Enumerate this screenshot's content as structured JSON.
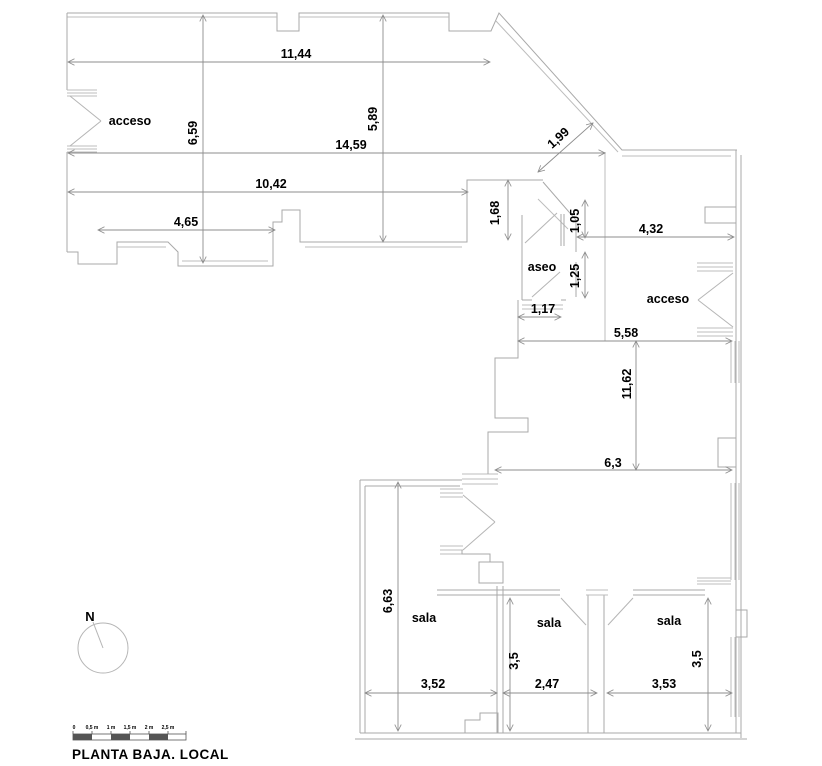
{
  "title": "PLANTA BAJA. LOCAL",
  "colors": {
    "background": "#ffffff",
    "wall_line": "#a9a9a9",
    "dimension_line": "#8c8c8c",
    "text": "#000000"
  },
  "north": {
    "label": "N"
  },
  "rooms": [
    {
      "name": "acceso-left",
      "label": "acceso"
    },
    {
      "name": "aseo",
      "label": "aseo"
    },
    {
      "name": "acceso-right",
      "label": "acceso"
    },
    {
      "name": "sala-1",
      "label": "sala"
    },
    {
      "name": "sala-2",
      "label": "sala"
    },
    {
      "name": "sala-3",
      "label": "sala"
    }
  ],
  "dimensions": [
    {
      "label": "11,44",
      "orientation": "horizontal"
    },
    {
      "label": "6,59",
      "orientation": "vertical"
    },
    {
      "label": "14,59",
      "orientation": "horizontal"
    },
    {
      "label": "5,89",
      "orientation": "vertical"
    },
    {
      "label": "1,99",
      "orientation": "diagonal"
    },
    {
      "label": "10,42",
      "orientation": "horizontal"
    },
    {
      "label": "4,65",
      "orientation": "horizontal"
    },
    {
      "label": "1,68",
      "orientation": "vertical"
    },
    {
      "label": "1,05",
      "orientation": "vertical"
    },
    {
      "label": "4,32",
      "orientation": "horizontal"
    },
    {
      "label": "1,25",
      "orientation": "vertical"
    },
    {
      "label": "1,17",
      "orientation": "horizontal"
    },
    {
      "label": "5,58",
      "orientation": "horizontal"
    },
    {
      "label": "11,62",
      "orientation": "vertical"
    },
    {
      "label": "6,3",
      "orientation": "horizontal"
    },
    {
      "label": "6,63",
      "orientation": "vertical"
    },
    {
      "label": "3,5",
      "orientation": "vertical"
    },
    {
      "label": "3,5",
      "orientation": "vertical"
    },
    {
      "label": "3,52",
      "orientation": "horizontal"
    },
    {
      "label": "2,47",
      "orientation": "horizontal"
    },
    {
      "label": "3,53",
      "orientation": "horizontal"
    }
  ],
  "scale_bar": {
    "ticks": [
      "0",
      "0,5 m",
      "1 m",
      "1,5 m",
      "2 m",
      "2,5 m"
    ]
  }
}
